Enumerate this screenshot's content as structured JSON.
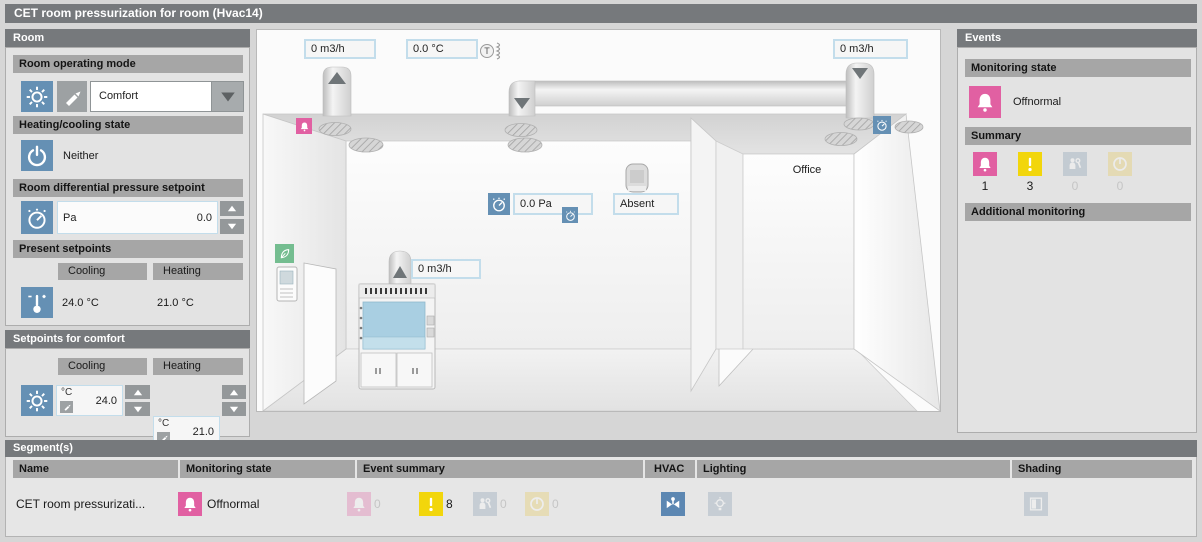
{
  "title": "CET room pressurization for room (Hvac14)",
  "room": {
    "header": "Room",
    "operating_mode_header": "Room operating mode",
    "operating_mode_value": "Comfort",
    "heating_cooling_header": "Heating/cooling state",
    "heating_cooling_value": "Neither",
    "diff_pressure_header": "Room differential pressure setpoint",
    "diff_pressure_unit": "Pa",
    "diff_pressure_value": "0.0",
    "present_setpoints_header": "Present setpoints",
    "cooling_label": "Cooling",
    "heating_label": "Heating",
    "present_cooling": "24.0 °C",
    "present_heating": "21.0 °C"
  },
  "comfort": {
    "header": "Setpoints for comfort",
    "cooling_label": "Cooling",
    "heating_label": "Heating",
    "cooling_unit": "°C",
    "cooling_value": "24.0",
    "heating_unit": "°C",
    "heating_value": "21.0"
  },
  "room_view": {
    "supply_air_flow": "0 m3/h",
    "supply_air_temp": "0.0 °C",
    "extract_air_flow": "0 m3/h",
    "fume_hood_flow": "0 m3/h",
    "room_pressure": "0.0 Pa",
    "presence_state": "Absent",
    "office_label": "Office"
  },
  "events": {
    "header": "Events",
    "monitoring_header": "Monitoring state",
    "monitoring_value": "Offnormal",
    "summary_header": "Summary",
    "summary_counts": {
      "alarm": "1",
      "warning": "3",
      "fault": "0",
      "disabled": "0"
    },
    "additional_header": "Additional monitoring"
  },
  "segments": {
    "header": "Segment(s)",
    "columns": {
      "name": "Name",
      "monitoring": "Monitoring state",
      "events": "Event summary",
      "hvac": "HVAC",
      "lighting": "Lighting",
      "shading": "Shading"
    },
    "row": {
      "name": "CET room pressurizati...",
      "monitoring_value": "Offnormal",
      "event_counts": {
        "alarm": "0",
        "warning": "8",
        "fault": "0",
        "disabled": "0"
      }
    }
  },
  "colors": {
    "accent_blue": "#6590b4",
    "alarm_pink": "#e160a2",
    "warning_yellow": "#f2d60c",
    "header_gray": "#76797c",
    "section_gray": "#a6a6a6"
  }
}
